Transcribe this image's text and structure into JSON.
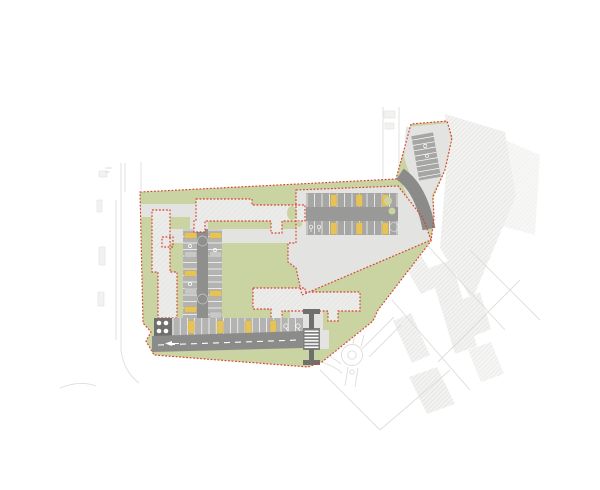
{
  "plan": {
    "kind": "architectural-site-plan",
    "visible_text": []
  },
  "colors": {
    "background": "#ffffff",
    "site_green": "#cad3a2",
    "paving": "#e3e3e1",
    "building_fill": "#ebebe9",
    "building_hatch": "#dddddb",
    "parking_stall_zone": "#b3b3b1",
    "parking_aisle": "#8f8f8d",
    "big_lot_fill": "#a6a6a4",
    "big_lot_aisle": "#999997",
    "road_dark": "#8b8b89",
    "crosswalk_dark": "#7f7f7d",
    "structure_dark": "#6f6f6d",
    "car_yellow": "#e7c254",
    "car_gray": "#c8c8c6",
    "boundary_red": "#d9402f",
    "context_line": "#dedddb",
    "context_hatch": "#d6d6d4",
    "context_fill": "#f2f2f0",
    "white": "#ffffff"
  },
  "generated": {
    "stall_lines": [
      {
        "container": "big-lot-top-stalls",
        "orient": "v",
        "from": 307,
        "to": 397,
        "step": 7.5,
        "a": 193.5,
        "b": 207
      },
      {
        "container": "big-lot-bottom-stalls",
        "orient": "v",
        "from": 307,
        "to": 397,
        "step": 7.5,
        "a": 221,
        "b": 234.5
      },
      {
        "container": "central-left-stalls",
        "orient": "h",
        "from": 230,
        "to": 320,
        "step": 6.5,
        "a": 183,
        "b": 197
      },
      {
        "container": "central-right-stalls",
        "orient": "h",
        "from": 230,
        "to": 320,
        "step": 6.5,
        "a": 208,
        "b": 222
      },
      {
        "container": "south-stalls-lines",
        "orient": "v",
        "from": 173,
        "to": 302,
        "step": 7.2,
        "a": 318,
        "b": 335
      },
      {
        "container": "lobe-stalls",
        "orient": "h",
        "from": 138,
        "to": 176,
        "step": 5.4,
        "a": 415,
        "b": 437
      }
    ],
    "cars": [
      {
        "container": "cars-central",
        "color": "car_yellow",
        "w": 12,
        "h": 6,
        "at": [
          [
            184.5,
            232.5
          ],
          [
            184.5,
            270.5
          ],
          [
            184.5,
            306.5
          ],
          [
            209.5,
            232.5
          ],
          [
            209.5,
            290.5
          ]
        ]
      },
      {
        "container": "cars-central",
        "color": "car_gray",
        "w": 12,
        "h": 6,
        "at": [
          [
            184.5,
            251.5
          ],
          [
            184.5,
            288
          ],
          [
            209.5,
            251.5
          ],
          [
            209.5,
            312
          ]
        ]
      },
      {
        "container": "cars-big-lot",
        "color": "car_yellow",
        "w": 6.5,
        "h": 12,
        "at": [
          [
            330.5,
            194.5
          ],
          [
            356,
            194.5
          ],
          [
            382,
            194.5
          ],
          [
            330.5,
            222.5
          ],
          [
            356,
            222.5
          ],
          [
            382,
            222.5
          ]
        ]
      },
      {
        "container": "cars-south",
        "color": "car_yellow",
        "w": 6.5,
        "h": 13,
        "at": [
          [
            188,
            320.5
          ],
          [
            217,
            320.5
          ],
          [
            245,
            320.5
          ],
          [
            270,
            320.5
          ]
        ]
      }
    ],
    "zebra": {
      "container": "crosswalk-stripes",
      "x": 304.5,
      "w": 14,
      "y1": 330.5,
      "y2": 346.5,
      "step": 3.2,
      "h": 1.5
    }
  }
}
